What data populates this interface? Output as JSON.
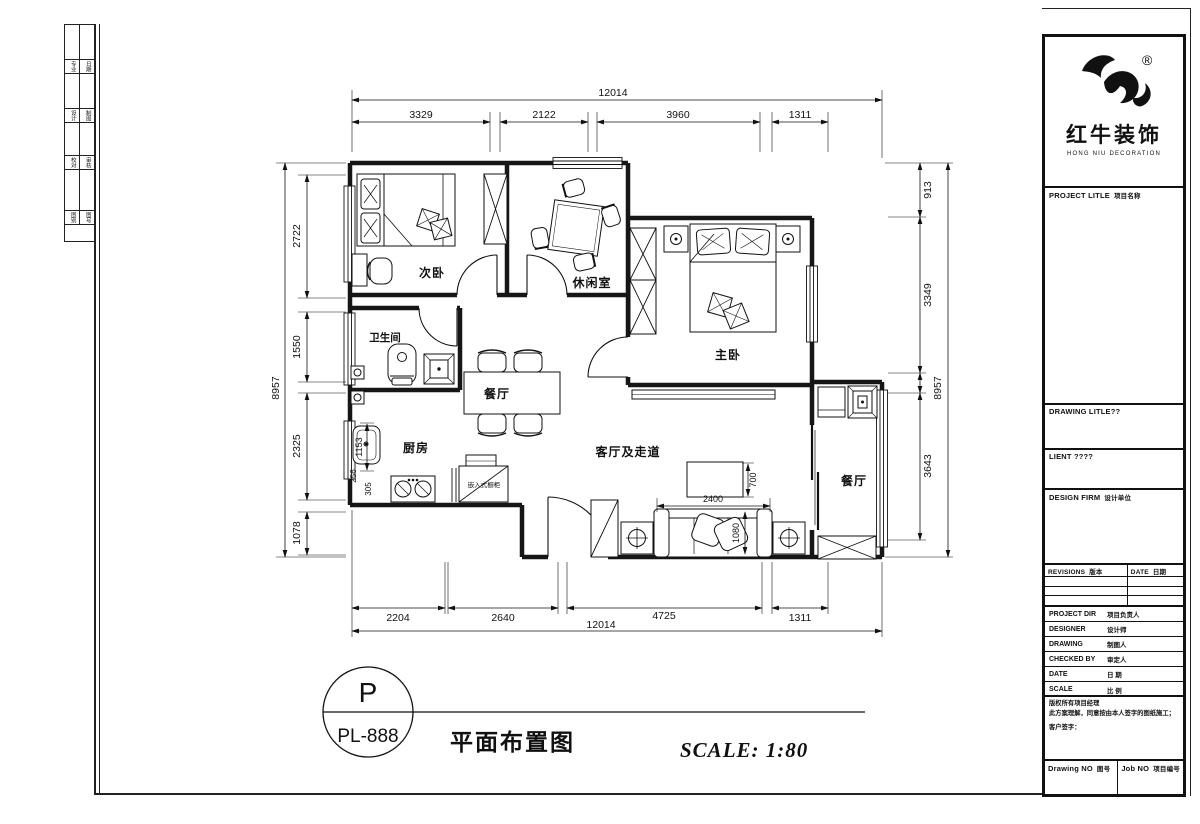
{
  "plan": {
    "rooms": {
      "ciwo": "次卧",
      "xiuxianshi": "休闲室",
      "zhuwo": "主卧",
      "weishengjian": "卫生间",
      "canting": "餐厅",
      "chufang": "厨房",
      "keting": "客厅及走道",
      "yangtai": "餐厅"
    },
    "cabinet_label": "嵌入式橱柜",
    "dims": {
      "top_total": "12014",
      "top": [
        "3329",
        "2122",
        "3960",
        "1311"
      ],
      "bottom": [
        "2204",
        "2640",
        "4725",
        "1311"
      ],
      "bottom_total": "12014",
      "left_total": "8957",
      "left": [
        "2722",
        "1550",
        "2325",
        "1078"
      ],
      "right": [
        "913",
        "3349",
        "3643"
      ],
      "right_total": "8957",
      "sofa_width": "2400",
      "table_depth": "700",
      "sofa_depth": "1080",
      "sink": "1153",
      "k1": "256",
      "k2": "305"
    }
  },
  "title_bar": {
    "code_top": "P",
    "code_bottom": "PL-888",
    "title": "平面布置图",
    "scale": "SCALE: 1:80"
  },
  "brand": {
    "cn": "红牛装饰",
    "en": "HONG NIU DECORATION",
    "reg": "®"
  },
  "title_block": {
    "project_title": {
      "en": "PROJECT LITLE",
      "cn": "项目名称"
    },
    "drawing_title": {
      "en": "DRAWING LITLE??"
    },
    "client": {
      "en": "LIENT ????"
    },
    "design_firm": {
      "en": "DESIGN FIRM",
      "cn": "设计单位"
    },
    "revisions": {
      "en": "REVISIONS",
      "cn": "版本"
    },
    "date_col": {
      "en": "DATE",
      "cn": "日期"
    },
    "rows": [
      {
        "en": "PROJECT DIR",
        "cn": "项目负责人"
      },
      {
        "en": "DESIGNER",
        "cn": "设计师"
      },
      {
        "en": "DRAWING",
        "cn": "制图人"
      },
      {
        "en": "CHECKED BY",
        "cn": "审定人"
      },
      {
        "en": "DATE",
        "cn": "日 期"
      },
      {
        "en": "SCALE",
        "cn": "比 例"
      }
    ],
    "notes": [
      "版权所有项目经理",
      "此方案理解，同意按由本人签字的图纸施工；",
      "客户签字："
    ],
    "drawing_no": {
      "en": "Drawing NO",
      "cn": "图号"
    },
    "job_no": {
      "en": "Job NO",
      "cn": "项目编号"
    }
  },
  "side_strip": {
    "rows": [
      [
        "专业",
        "日期"
      ],
      [
        "设计",
        "制图"
      ],
      [
        "校对",
        "审核"
      ],
      [
        "图别",
        "图号"
      ]
    ]
  }
}
